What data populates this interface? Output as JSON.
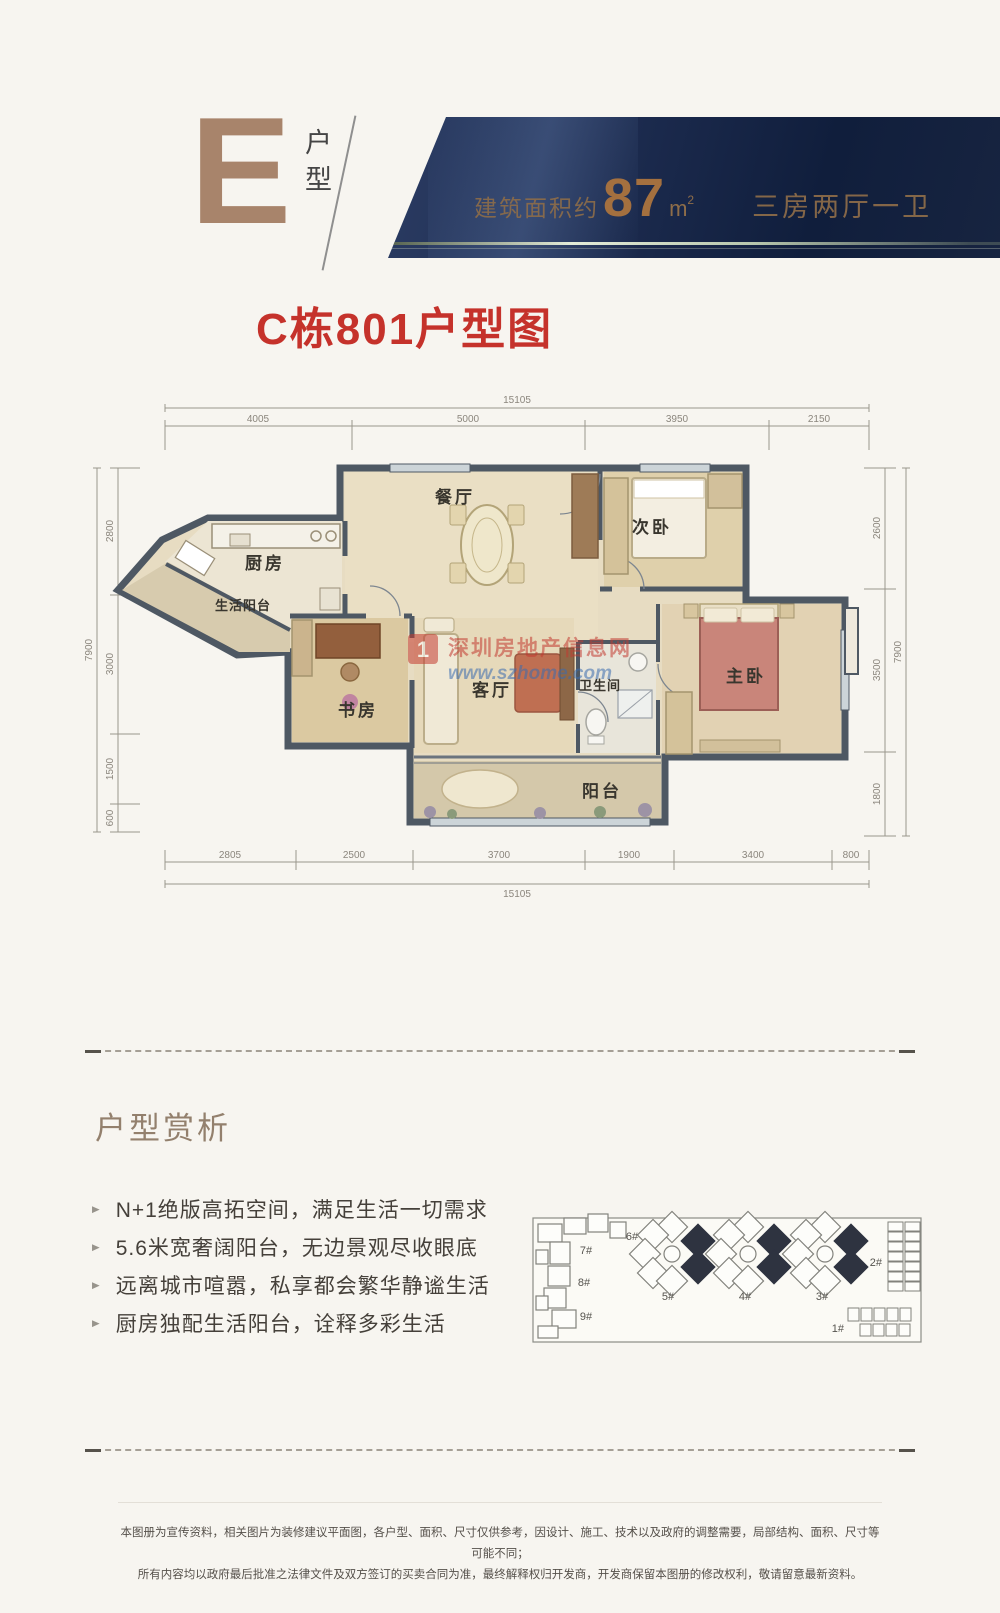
{
  "colors": {
    "accent_bronze": "#a8846b",
    "banner_navy": "#16243f",
    "banner_text_bronze": "#8e6d49",
    "title_red": "#c5322b",
    "wall": "#4e5863",
    "floor_tan": "#e7dcc2",
    "siteplan_highlight": "#2e3340"
  },
  "header": {
    "unit_letter": "E",
    "unit_label": "户型",
    "area_prefix": "建筑面积约",
    "area_value": "87",
    "area_unit_base": "m",
    "area_unit_sup": "2",
    "layout_text": "三房两厅一卫"
  },
  "title": {
    "text": "C栋801户型图"
  },
  "floorplan": {
    "rooms": {
      "dining": "餐厅",
      "second_bedroom": "次卧",
      "kitchen": "厨房",
      "utility_balcony": "生活阳台",
      "study": "书房",
      "living": "客厅",
      "bathroom": "卫生间",
      "master_bedroom": "主卧",
      "balcony": "阳台"
    },
    "watermark": {
      "logo": "1",
      "site_name": "深圳房地产信息网",
      "site_url": "www.szhome.com"
    },
    "dims": {
      "top_total": "15105",
      "top_segments": [
        "4005",
        "5000",
        "3950",
        "2150"
      ],
      "bottom_total": "15105",
      "bottom_segments": [
        "2805",
        "2500",
        "3700",
        "1900",
        "3400",
        "800"
      ],
      "left_total": "7900",
      "left_segments": [
        "2800",
        "3000",
        "1500",
        "600"
      ],
      "right_total": "7900",
      "right_segments": [
        "2600",
        "3500",
        "1800"
      ]
    }
  },
  "analysis": {
    "title": "户型赏析",
    "bullets": [
      "N+1绝版高拓空间，满足生活一切需求",
      "5.6米宽奢阔阳台，无边景观尽收眼底",
      "远离城市喧嚣，私享都会繁华静谧生活",
      "厨房独配生活阳台，诠释多彩生活"
    ]
  },
  "siteplan": {
    "building_labels": {
      "b1": "1#",
      "b2": "2#",
      "b3": "3#",
      "b4": "4#",
      "b5": "5#",
      "b6": "6#",
      "b7": "7#",
      "b8": "8#",
      "b9": "9#"
    }
  },
  "disclaimer": {
    "line1": "本图册为宣传资料，相关图片为装修建议平面图，各户型、面积、尺寸仅供参考，因设计、施工、技术以及政府的调整需要，局部结构、面积、尺寸等可能不同；",
    "line2": "所有内容均以政府最后批准之法律文件及双方签订的买卖合同为准，最终解释权归开发商，开发商保留本图册的修改权利，敬请留意最新资料。"
  }
}
